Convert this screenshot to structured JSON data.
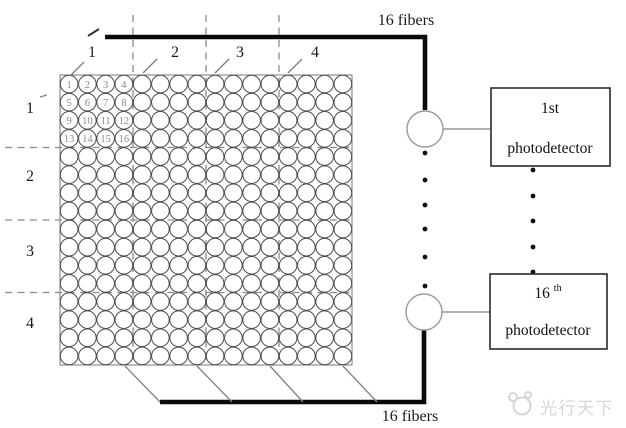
{
  "diagram": {
    "title_top": "16 fibers",
    "title_bottom": "16 fibers",
    "column_labels": [
      "1",
      "2",
      "3",
      "4"
    ],
    "row_labels": [
      "1",
      "2",
      "3",
      "4"
    ],
    "grid": {
      "rows": 16,
      "cols": 16,
      "numbered_block": {
        "rows": 4,
        "cols": 4,
        "numbers": [
          "1",
          "2",
          "3",
          "4",
          "5",
          "6",
          "7",
          "8",
          "9",
          "10",
          "11",
          "12",
          "13",
          "14",
          "15",
          "16"
        ]
      }
    },
    "photodetectors": [
      {
        "ordinal": "1st",
        "suffix": "",
        "label": "photodetector"
      },
      {
        "ordinal": "16",
        "suffix": "th",
        "label": "photodetector"
      }
    ],
    "watermark_text": "光行天下",
    "colors": {
      "line": "#0a0a0a",
      "grid_stroke": "#4d4d4d",
      "grid_border": "#777777",
      "dashed": "#8a8a8a",
      "thin": "#808080",
      "numbers": "#8a8a8a",
      "watermark": "#d6d6d6"
    }
  }
}
